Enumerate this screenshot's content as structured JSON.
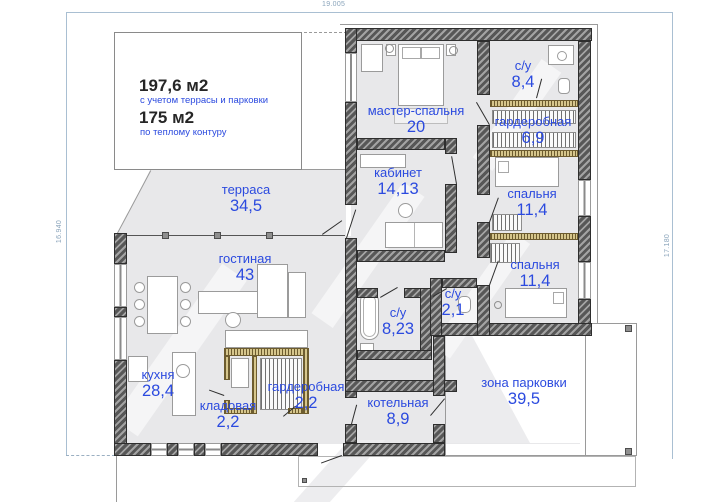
{
  "info": {
    "total_area": "197,6 м2",
    "total_area_note": "с учетом террасы и парковки",
    "heated_area": "175 м2",
    "heated_area_note": "по теплому контуру"
  },
  "dimensions": {
    "top": "19.005",
    "left": "16.940",
    "right": "17.180"
  },
  "rooms": [
    {
      "name": "терраса",
      "area": "34,5"
    },
    {
      "name": "гостиная",
      "area": "43"
    },
    {
      "name": "мастер-спальня",
      "area": "20"
    },
    {
      "name": "кабинет",
      "area": "14,13"
    },
    {
      "name": "с/у",
      "area": "8,4"
    },
    {
      "name": "гардеробная",
      "area": "6,9"
    },
    {
      "name": "спальня",
      "area": "11,4"
    },
    {
      "name": "спальня",
      "area": "11,4"
    },
    {
      "name": "с/у",
      "area": "2,1"
    },
    {
      "name": "с/у",
      "area": "8,23"
    },
    {
      "name": "кухня",
      "area": "28,4"
    },
    {
      "name": "кладовая",
      "area": "2,2"
    },
    {
      "name": "гардеробная",
      "area": "2,2"
    },
    {
      "name": "котельная",
      "area": "8,9"
    },
    {
      "name": "зона парковки",
      "area": "39,5"
    }
  ],
  "colors": {
    "label_blue": "#2b4adf",
    "wall_gray": "#575757",
    "floor_gray": "#e8e8ea",
    "dimension_blue": "#8aa4bb"
  }
}
